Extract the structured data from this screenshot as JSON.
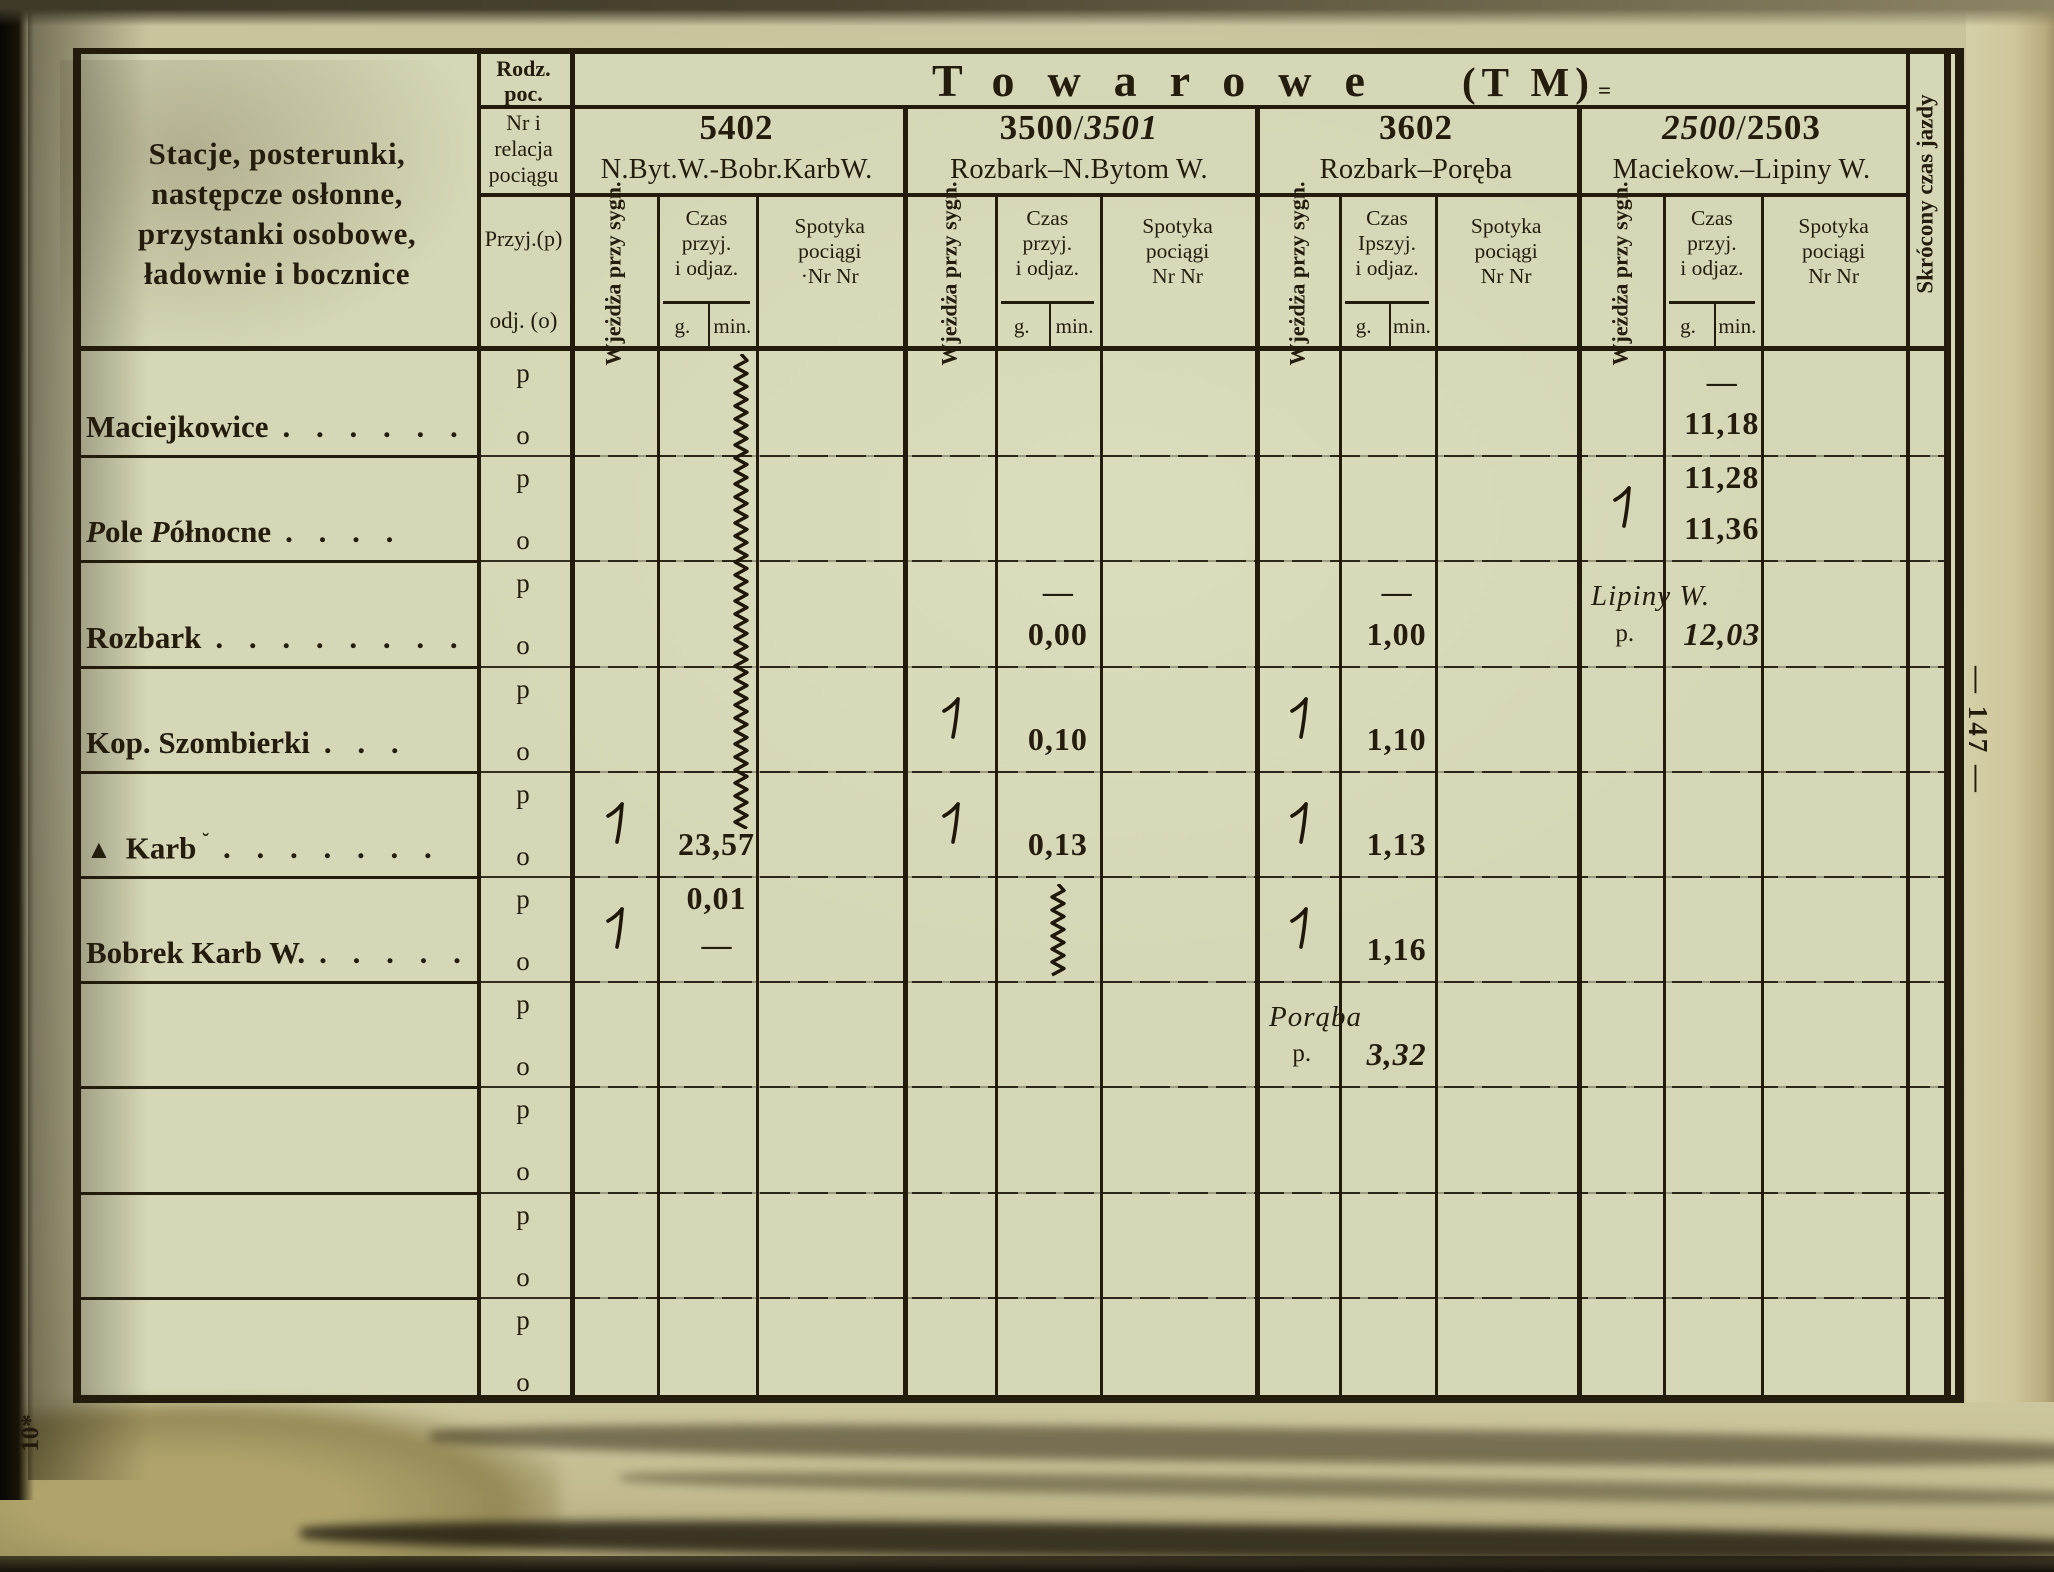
{
  "page": {
    "number": "— 147 —",
    "corner_mark": "10*"
  },
  "header": {
    "stations_title": "Stacje, posterunki,\nnastępcze osłonne,\nprzystanki osobowe,\nładownie i bocznice",
    "rodz_top": "Rodz.\npoc.",
    "rodz_mid": "Nr i\nrelacja\npociągu",
    "przyj": "Przyj.(p)",
    "odj": "odj. (o)",
    "group_word": "Towarowe",
    "group_abbr": "(T M)",
    "group_mark": "=",
    "right_col": "Skrócony czas jazdy"
  },
  "row_letters": {
    "p": "p",
    "o": "o"
  },
  "trains": [
    {
      "number_parts": [
        {
          "t": "5402",
          "b": true
        }
      ],
      "route": "N.Byt.W.-Bobr.KarbW.",
      "wjezdza": "Wjeżdża\nprzy sygn.",
      "czas": "Czas\nprzyj.\ni odjaz.",
      "g": "g.",
      "min": "min.",
      "spotyka": "Spotyka\npociągi\n·Nr Nr"
    },
    {
      "number_parts": [
        {
          "t": "3500",
          "b": true
        },
        {
          "t": "/"
        },
        {
          "t": "3501",
          "it": true
        }
      ],
      "route": "Rozbark–N.Bytom W.",
      "wjezdza": "Wjeżdża\nprzy sygn.",
      "czas": "Czas\nprzyj.\ni odjaz.",
      "g": "g.",
      "min": "min.",
      "spotyka": "Spotyka\npociągi\nNr Nr"
    },
    {
      "number_parts": [
        {
          "t": "3602",
          "b": true
        }
      ],
      "route": "Rozbark–Poręba",
      "wjezdza": "Wjeżdża\nprzy sygn.",
      "czas": "Czas\nIpszyj.\ni odjaz.",
      "g": "g.",
      "min": "min.",
      "spotyka": "Spotyka\npociągi\nNr Nr"
    },
    {
      "number_parts": [
        {
          "t": "2500",
          "it": true
        },
        {
          "t": "/"
        },
        {
          "t": "2503",
          "b": true
        }
      ],
      "route": "Maciekow.–Lipiny W.",
      "wjezdza": "Wjeżdża\nprzy sygn.",
      "czas": "Czas\nprzyj.\ni odjaz.",
      "g": "g.",
      "min": "min.",
      "spotyka": "Spotyka\npociągi\nNr Nr"
    }
  ],
  "stations": [
    {
      "parts": [
        {
          "t": "Maciejkowice"
        }
      ],
      "dots": ". . . . . ."
    },
    {
      "parts": [
        {
          "t": "P",
          "it": true
        },
        {
          "t": "ole "
        },
        {
          "t": "P",
          "it": true
        },
        {
          "t": "ółnocne"
        }
      ],
      "dots": ". . . ."
    },
    {
      "parts": [
        {
          "t": "Rozbark"
        }
      ],
      "dots": ". . . . . . . ."
    },
    {
      "parts": [
        {
          "t": "Kop. Szombierki"
        }
      ],
      "dots": ". . ."
    },
    {
      "prefix": "▲",
      "parts": [
        {
          "t": "Karb"
        }
      ],
      "mark": "˘",
      "dots": ". . . . . . ."
    },
    {
      "parts": [
        {
          "t": "Bobrek Karb W."
        }
      ],
      "dots": ". . . . ."
    },
    {},
    {},
    {},
    {}
  ],
  "cells": [
    {
      "train": 0,
      "block": 4,
      "row": "p",
      "slot": "sig"
    },
    {
      "train": 0,
      "block": 4,
      "row": "o",
      "slot": "time",
      "value": "23,57"
    },
    {
      "train": 0,
      "block": 5,
      "row": "p",
      "slot": "time",
      "value": "0,01",
      "pos": "top"
    },
    {
      "train": 0,
      "block": 5,
      "row": "p",
      "slot": "sig"
    },
    {
      "train": 0,
      "block": 5,
      "row": "o",
      "slot": "dash"
    },
    {
      "train": 1,
      "block": 2,
      "row": "p",
      "slot": "dash"
    },
    {
      "train": 1,
      "block": 2,
      "row": "o",
      "slot": "time",
      "value": "0,00"
    },
    {
      "train": 1,
      "block": 3,
      "row": "p",
      "slot": "sig"
    },
    {
      "train": 1,
      "block": 3,
      "row": "o",
      "slot": "time",
      "value": "0,10"
    },
    {
      "train": 1,
      "block": 4,
      "row": "p",
      "slot": "sig"
    },
    {
      "train": 1,
      "block": 4,
      "row": "o",
      "slot": "time",
      "value": "0,13"
    },
    {
      "train": 2,
      "block": 2,
      "row": "p",
      "slot": "dash"
    },
    {
      "train": 2,
      "block": 2,
      "row": "o",
      "slot": "time",
      "value": "1,00"
    },
    {
      "train": 2,
      "block": 3,
      "row": "p",
      "slot": "sig"
    },
    {
      "train": 2,
      "block": 3,
      "row": "o",
      "slot": "time",
      "value": "1,10"
    },
    {
      "train": 2,
      "block": 4,
      "row": "p",
      "slot": "sig"
    },
    {
      "train": 2,
      "block": 4,
      "row": "o",
      "slot": "time",
      "value": "1,13"
    },
    {
      "train": 2,
      "block": 5,
      "row": "p",
      "slot": "sig"
    },
    {
      "train": 2,
      "block": 5,
      "row": "o",
      "slot": "time",
      "value": "1,16"
    },
    {
      "train": 2,
      "block": 6,
      "row": "p",
      "slot": "name",
      "value": "Porąba"
    },
    {
      "train": 2,
      "block": 6,
      "row": "o",
      "slot": "mark",
      "value": "p."
    },
    {
      "train": 2,
      "block": 6,
      "row": "o",
      "slot": "time",
      "value": "3,32",
      "italic": true
    },
    {
      "train": 3,
      "block": 0,
      "row": "p",
      "slot": "dash"
    },
    {
      "train": 3,
      "block": 0,
      "row": "o",
      "slot": "time",
      "value": "11,18"
    },
    {
      "train": 3,
      "block": 1,
      "row": "p",
      "slot": "time",
      "value": "11,28",
      "pos": "top"
    },
    {
      "train": 3,
      "block": 1,
      "row": "p",
      "slot": "sig"
    },
    {
      "train": 3,
      "block": 1,
      "row": "o",
      "slot": "time",
      "value": "11,36"
    },
    {
      "train": 3,
      "block": 2,
      "row": "p",
      "slot": "name",
      "value": "Lipiny W."
    },
    {
      "train": 3,
      "block": 2,
      "row": "o",
      "slot": "mark",
      "value": "p."
    },
    {
      "train": 3,
      "block": 2,
      "row": "o",
      "slot": "time",
      "value": "12,03",
      "italic": true
    }
  ],
  "squiggles": [
    {
      "train": 0,
      "from_block": 0,
      "from_off": 4,
      "to_block": 4,
      "to_off": 58
    },
    {
      "train": 1,
      "from_block": 5,
      "from_off": 8,
      "to_block": 5,
      "to_off": 105
    }
  ]
}
